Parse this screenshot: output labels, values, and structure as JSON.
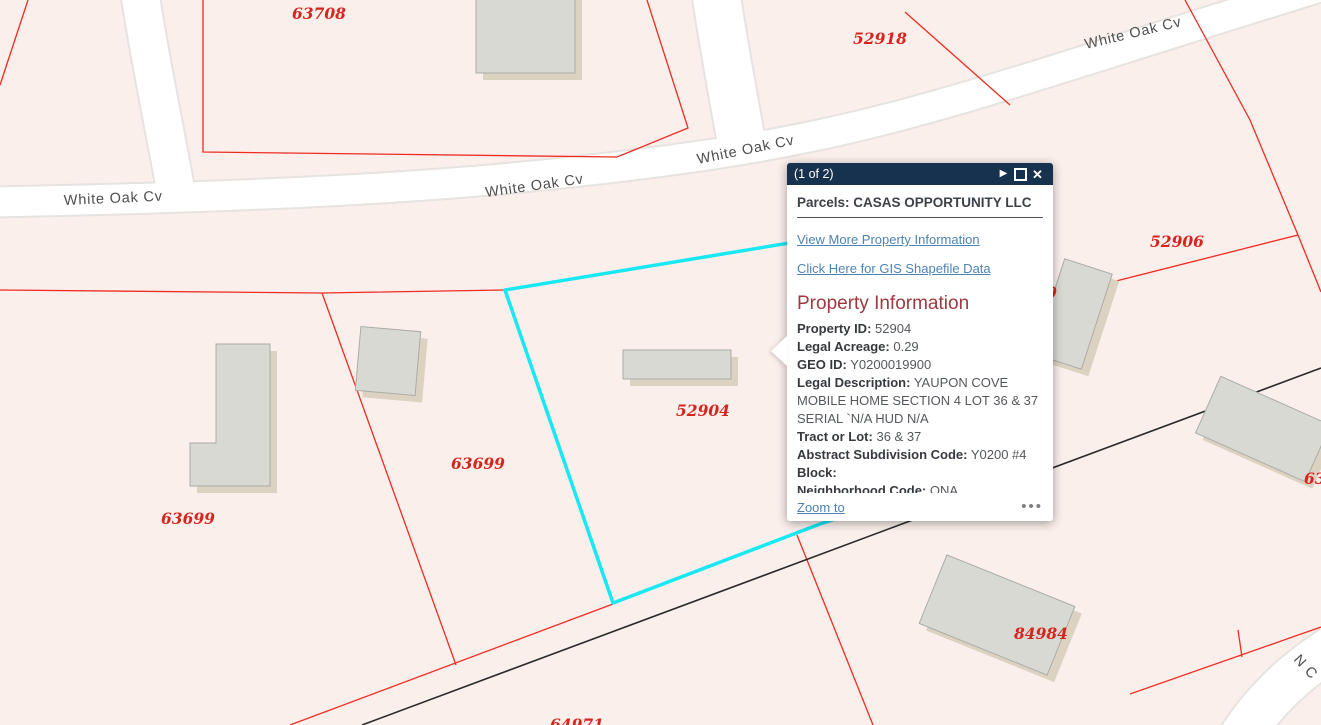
{
  "popup": {
    "pagination": "(1 of 2)",
    "title": "Parcels: CASAS OPPORTUNITY LLC",
    "links": {
      "more_info": "View More Property Information",
      "shapefile": "Click Here for GIS Shapefile Data"
    },
    "section_heading": "Property Information",
    "fields": [
      {
        "label": "Property ID:",
        "value": "52904"
      },
      {
        "label": "Legal Acreage:",
        "value": "0.29"
      },
      {
        "label": "GEO ID:",
        "value": "Y0200019900"
      },
      {
        "label": "Legal Description:",
        "value": "YAUPON COVE MOBILE HOME SECTION 4 LOT 36 & 37 SERIAL `N/A HUD N/A"
      },
      {
        "label": "Tract or Lot:",
        "value": "36 & 37"
      },
      {
        "label": "Abstract Subdivision Code:",
        "value": "Y0200 #4"
      },
      {
        "label": "Block:",
        "value": ""
      },
      {
        "label": "Neighborhood Code:",
        "value": "ONA"
      },
      {
        "label": "School District:",
        "value": "ION"
      }
    ],
    "zoom_to": "Zoom to",
    "more_options_icon": "•••",
    "close_icon": "✕",
    "next_icon": "▶",
    "header_color": "#16324e",
    "link_color": "#4d83b3",
    "heading_color": "#9e3940"
  },
  "map": {
    "highlighted_parcel": "52904",
    "highlight_color": "#18e8f2",
    "parcel_line_color": "#ee2c22",
    "parcel_label_color": "#d6241e",
    "background_color": "#fbefeb",
    "road_labels": [
      "White Oak Cv",
      "White Oak Cv",
      "White Oak Cv",
      "White Oak Cv",
      "N C"
    ],
    "parcel_labels": [
      "63708",
      "52918",
      "52906",
      "52904",
      "63699",
      "63699",
      "84984",
      "64971",
      "63",
      "0"
    ]
  }
}
